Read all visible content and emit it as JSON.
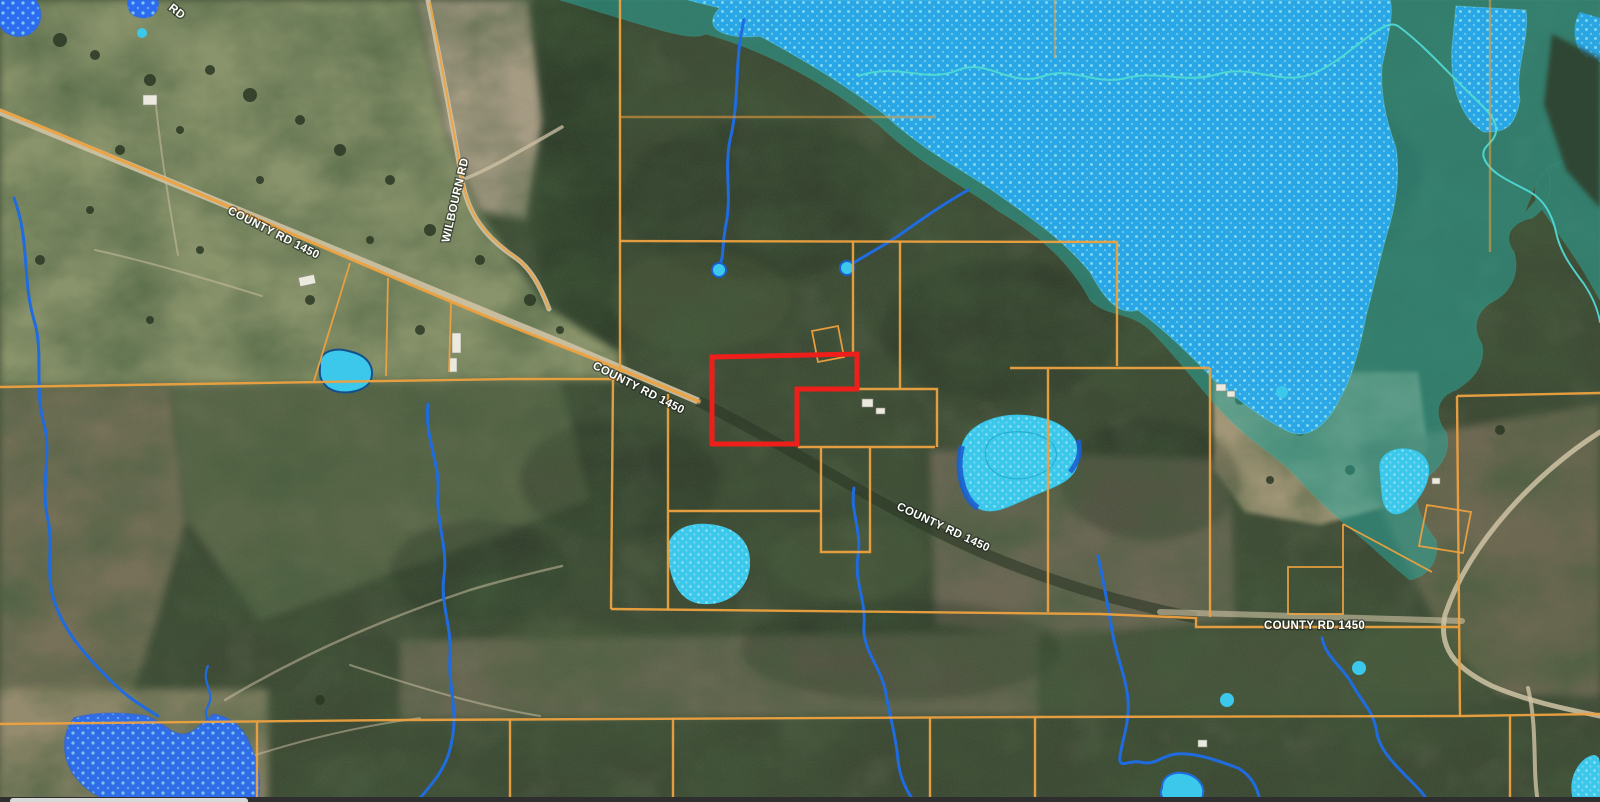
{
  "map": {
    "road_labels": [
      {
        "id": "county-rd-1450-nw",
        "text": "COUNTY RD 1450"
      },
      {
        "id": "county-rd-1450-center",
        "text": "COUNTY RD 1450"
      },
      {
        "id": "county-rd-1450-mid",
        "text": "COUNTY RD 1450"
      },
      {
        "id": "county-rd-1450-east",
        "text": "COUNTY RD 1450"
      },
      {
        "id": "wilbourn-rd",
        "text": "WILBOURN RD"
      },
      {
        "id": "top-edge-road-partial",
        "text": "RD"
      }
    ],
    "colors": {
      "parcel-line": "#eda13f",
      "selected-parcel": "#ee1f1b",
      "stream-blue": "#1f6be0",
      "flood-teal": "#2aa89e",
      "floodway-blue": "#29aaf0",
      "floodway-dot": "#90e4fb",
      "flood-darkblue": "#2d6cf0",
      "flood-darkblue-dot": "#7fd4f4",
      "pond-cyan": "#3cc8ea",
      "creek-teal": "#4fd9d4",
      "road-tan": "#cfc3a5",
      "label-text": "#ffffff"
    }
  }
}
